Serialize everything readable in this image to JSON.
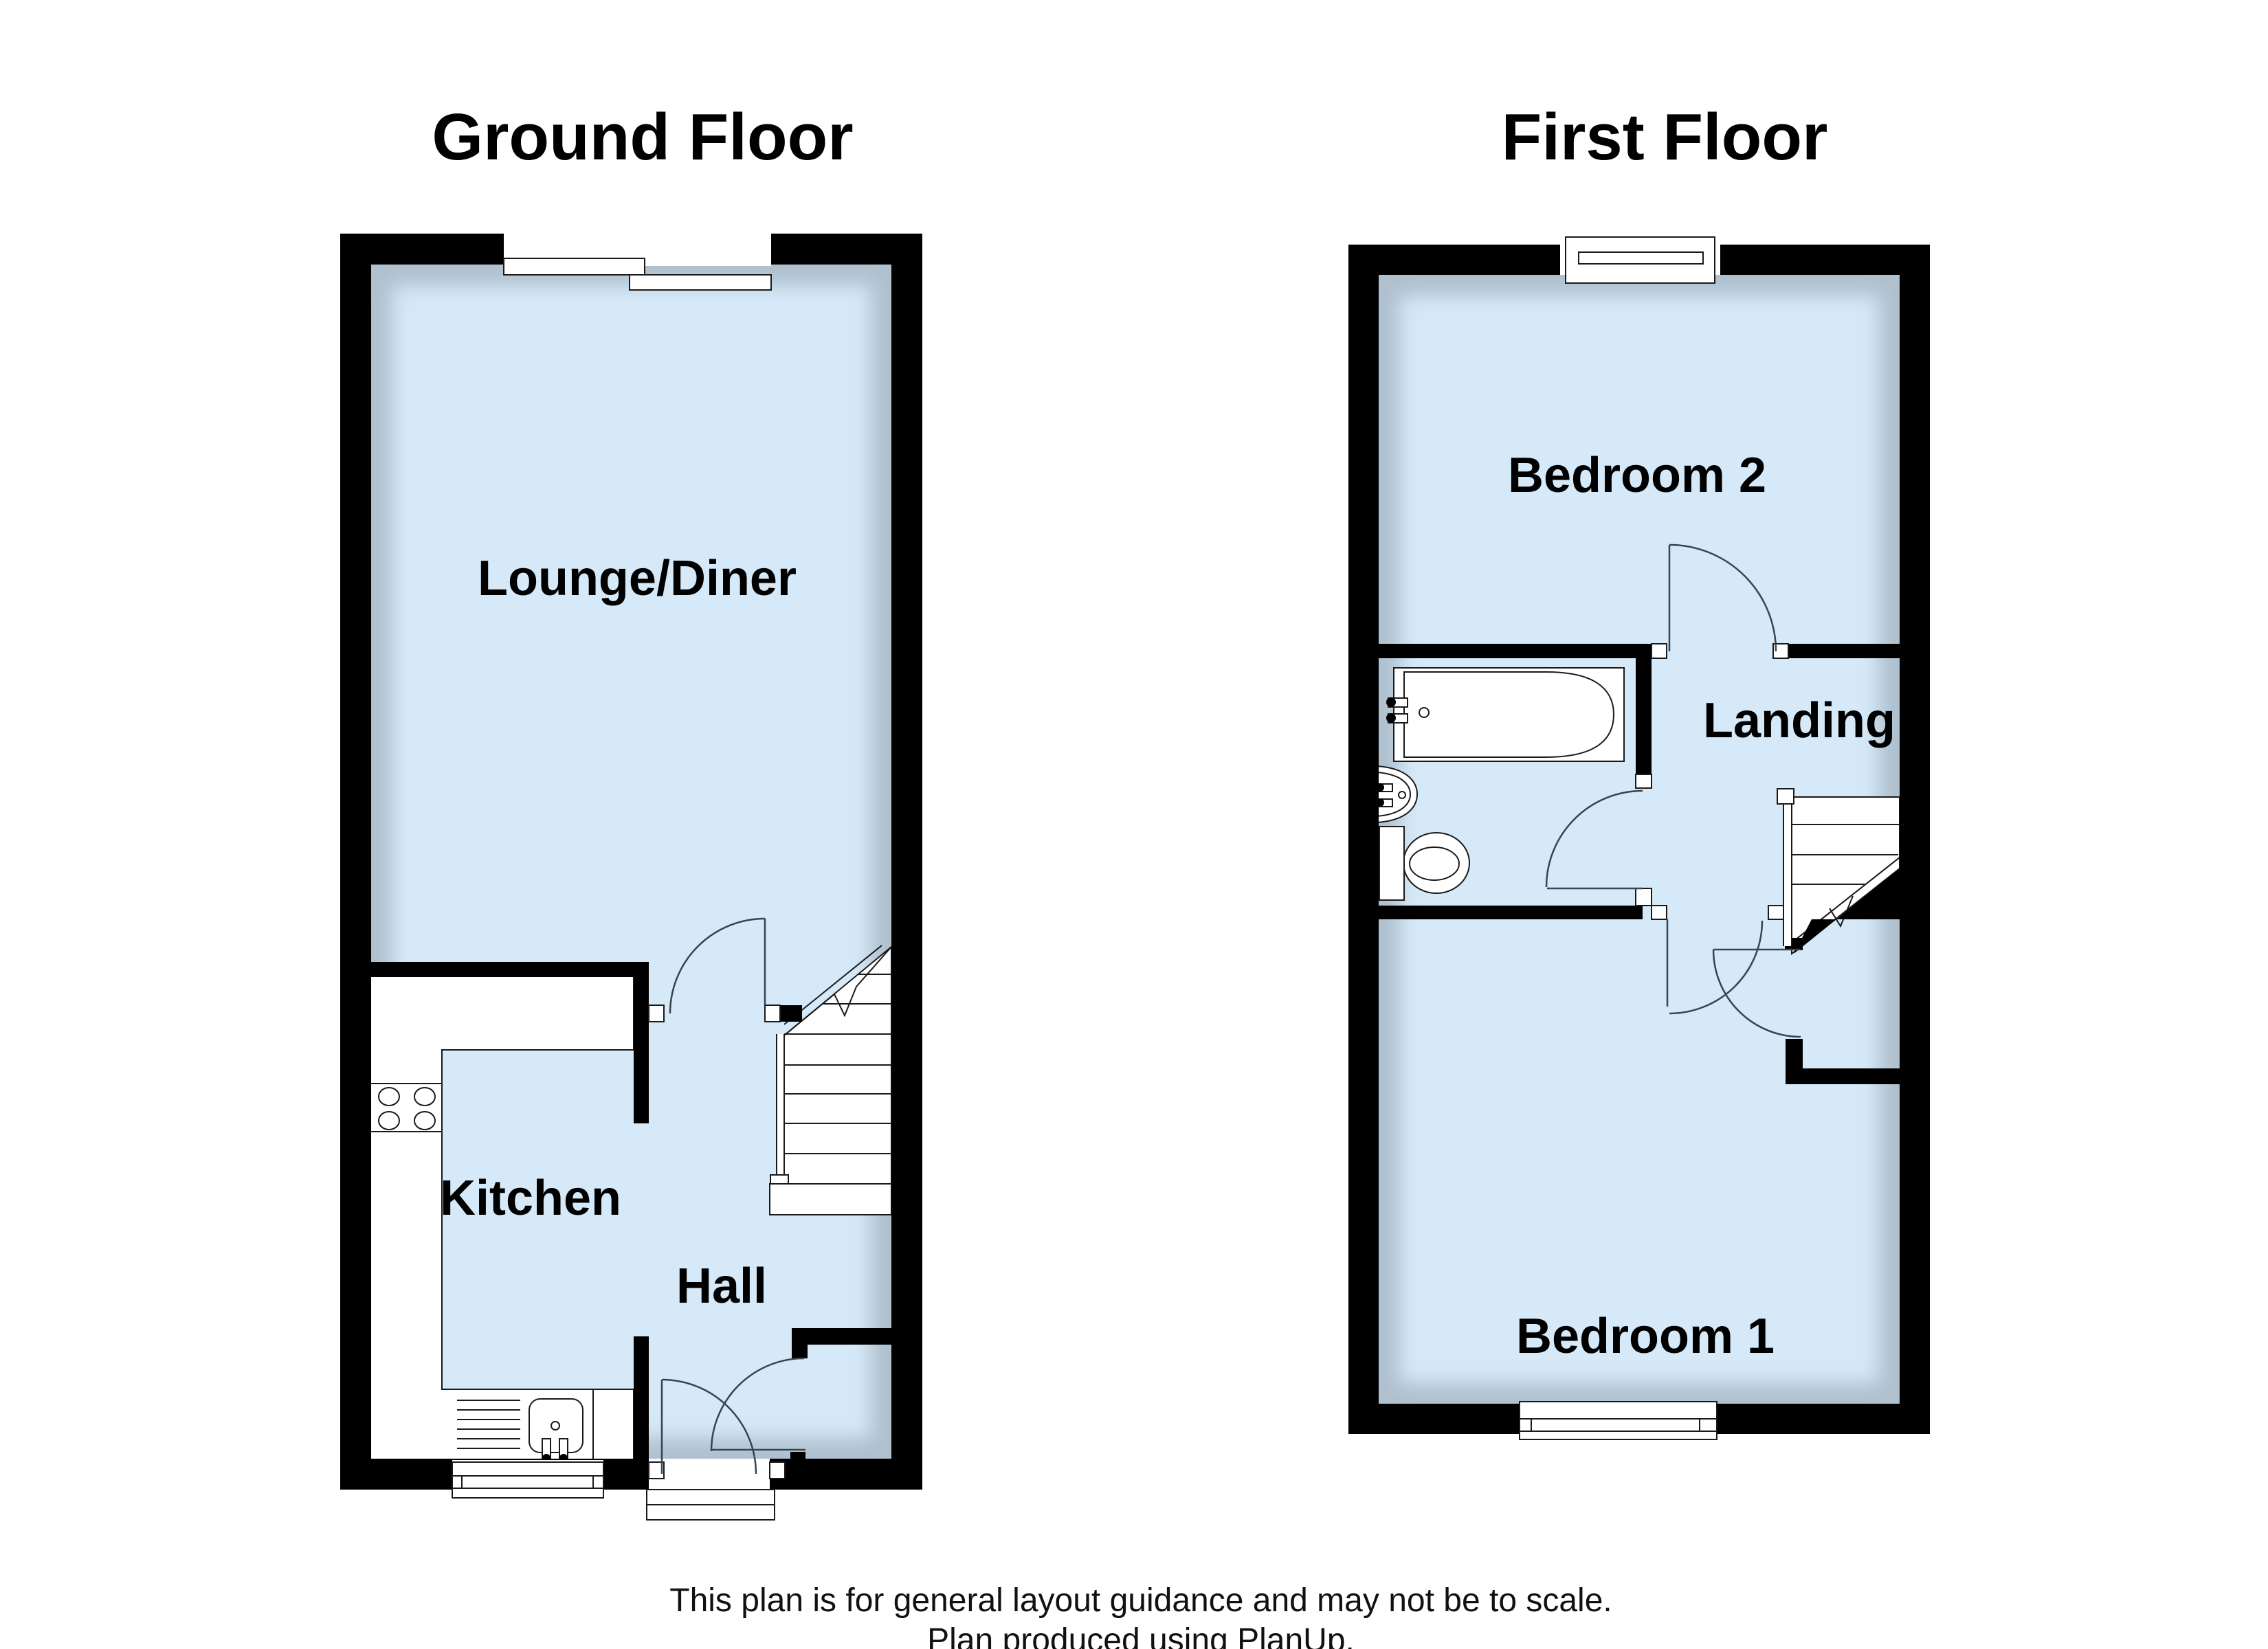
{
  "document": {
    "type": "floor-plan",
    "producer_note": "Plan produced using PlanUp."
  },
  "titles": {
    "ground_floor": "Ground Floor",
    "first_floor": "First Floor"
  },
  "ground_floor": {
    "rooms": {
      "lounge_diner": "Lounge/Diner",
      "kitchen": "Kitchen",
      "hall": "Hall"
    }
  },
  "first_floor": {
    "rooms": {
      "bedroom2": "Bedroom 2",
      "landing": "Landing",
      "bedroom1": "Bedroom 1"
    }
  },
  "footer": {
    "line1": "This plan is for general layout guidance and may not be to scale.",
    "line2": "Plan produced using PlanUp."
  },
  "colors": {
    "background": "#ffffff",
    "room_fill": "#d5e9f8",
    "wall": "#000000",
    "door_arc": "#36454f"
  },
  "icons": {
    "fixtures": [
      "bath-icon",
      "basin-icon",
      "toilet-icon",
      "hob-icon",
      "sink-drainer-icon",
      "stairs-icon",
      "window-icon",
      "door-arc-icon",
      "front-door-threshold"
    ]
  }
}
